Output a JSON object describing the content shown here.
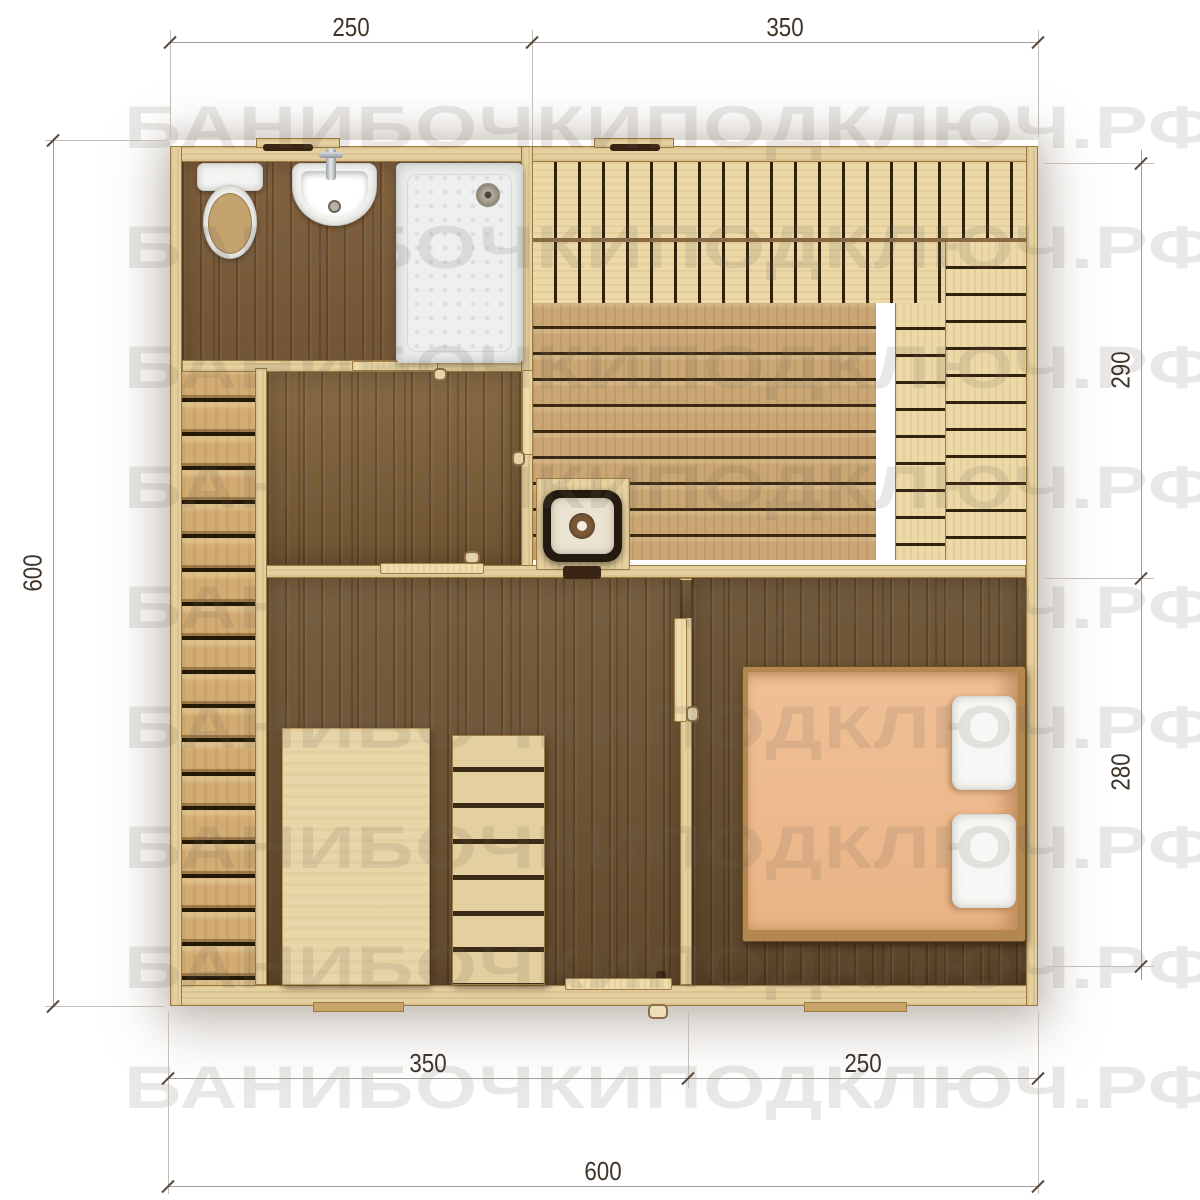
{
  "watermark": {
    "text": "БАНИБОЧКИПОДКЛЮЧ.РФ"
  },
  "dimensions": {
    "top_left": "250",
    "top_right": "350",
    "left_total": "600",
    "right_upper": "290",
    "right_lower": "280",
    "bottom_left": "350",
    "bottom_right": "250",
    "bottom_total": "600"
  },
  "colors": {
    "wall_wood": "#e4cf9e",
    "floor_dark": "#6f5433",
    "terrace_board": "#d2ac72",
    "bench_board": "#ecd9a7",
    "sauna_plank": "#c9a673",
    "bed_blanket": "#ecb88c",
    "dim_text": "#3e342a",
    "watermark": "rgba(109,99,89,0.15)"
  }
}
